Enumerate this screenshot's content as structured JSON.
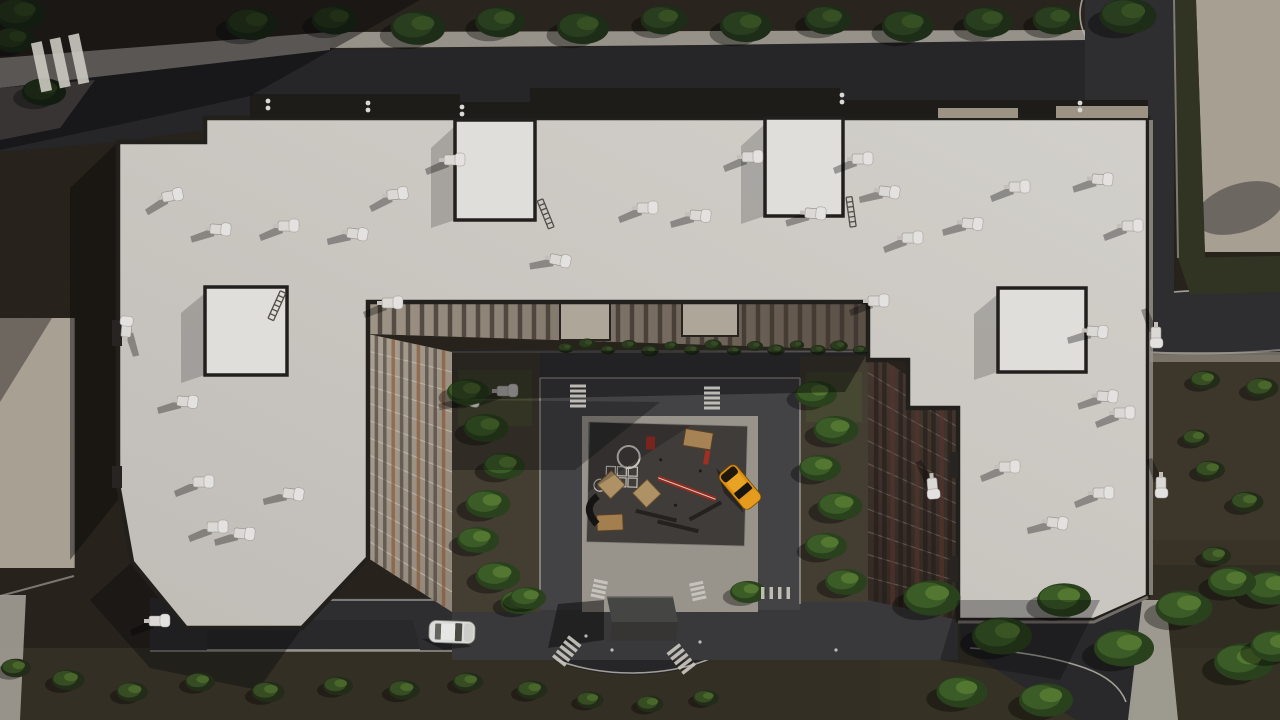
{
  "scene": {
    "title": "Aerial top-down 3D render of a residential apartment complex",
    "description": "U-shaped multi-wing apartment building with light flat roofs, rooftop HVAC units and stair penthouses, inner courtyard with playground and loop road, oval traffic circle with underground-parking entrance box, perimeter streets, dirt ground and rows of trees",
    "lighting": "low sun from the right; long shadows cast to the lower-left"
  },
  "palette": {
    "dirt": "#332e25",
    "dirt_light": "#453e31",
    "dirt_bottom": "#3a3428",
    "dirt_top": "#2c2820",
    "asphalt": "#313033",
    "asphalt_dark": "#29282a",
    "asphalt_apron": "#2c2b2d",
    "asphalt_lit": "#6e6a62",
    "courtyard_ground": "#3d3c3e",
    "loop_road": "#47474a",
    "sidewalk": "#b4afa6",
    "paving_light": "#a8a39a",
    "apron_paving": "#a29d94",
    "roof": "#d9d6d1",
    "roof_bright": "#edebe7",
    "parapet": "#25221e",
    "roof_band": "#201e1b",
    "facade_beige": "#b0a597",
    "facade_dark": "#46392f",
    "facade_accent": "#8c4f26",
    "tree_dark": "#2c4220",
    "tree_bright": "#40622a",
    "hedge": "#343726",
    "lawn": "#4f5a33",
    "playground_surface": "#44403e",
    "wood": "#b08a5a",
    "equipment_red": "#a83224",
    "taxi_orange": "#ef9a12",
    "car_white": "#e8e8e6",
    "hvac_white": "#e8e6e2",
    "marking_white": "#d8d5cd",
    "shadow": "rgba(10,10,12,0.5)"
  },
  "building": {
    "wings": [
      "left wing",
      "top bar",
      "right wing"
    ],
    "penthouses": 4,
    "hvac_count": 38,
    "inner_facades": "beige with dark window strips (left/top), dark brown with maroon strips (right)"
  },
  "objects": {
    "vehicles": [
      {
        "name": "orange-taxi",
        "x": 740,
        "y": 487,
        "rotation": 50,
        "color_ref": "taxi_orange"
      },
      {
        "name": "white-sedan",
        "x": 452,
        "y": 632,
        "rotation": 2,
        "color_ref": "car_white"
      }
    ],
    "oval_structure": {
      "name": "parking-entrance-box",
      "x": 640,
      "y": 618
    },
    "playground": {
      "surface": "dark rubber pad",
      "equipment": [
        "game-circle-marking",
        "hopscotch-grid",
        "wooden-table",
        "sand-diamond-1",
        "sand-diamond-2",
        "balance-beam",
        "benches",
        "wood-box",
        "climb-tube",
        "red-panel"
      ]
    },
    "hvac_units": [
      [
        165,
        196,
        -10
      ],
      [
        213,
        228,
        4
      ],
      [
        281,
        225,
        0
      ],
      [
        350,
        232,
        8
      ],
      [
        390,
        194,
        -6
      ],
      [
        447,
        159,
        0
      ],
      [
        553,
        258,
        12
      ],
      [
        640,
        207,
        0
      ],
      [
        693,
        214,
        6
      ],
      [
        745,
        156,
        0
      ],
      [
        808,
        212,
        4
      ],
      [
        855,
        158,
        0
      ],
      [
        882,
        190,
        8
      ],
      [
        905,
        237,
        0
      ],
      [
        965,
        222,
        6
      ],
      [
        1012,
        186,
        0
      ],
      [
        1095,
        178,
        4
      ],
      [
        1125,
        225,
        0
      ],
      [
        385,
        302,
        0
      ],
      [
        462,
        398,
        10
      ],
      [
        500,
        390,
        0
      ],
      [
        180,
        400,
        6
      ],
      [
        196,
        481,
        0
      ],
      [
        286,
        492,
        8
      ],
      [
        210,
        526,
        0
      ],
      [
        237,
        532,
        6
      ],
      [
        1002,
        466,
        0
      ],
      [
        1050,
        521,
        8
      ],
      [
        1096,
        492,
        0
      ],
      [
        1100,
        395,
        4
      ],
      [
        1117,
        412,
        0
      ],
      [
        1090,
        330,
        6
      ],
      [
        933,
        481,
        85
      ],
      [
        1157,
        330,
        90
      ],
      [
        1162,
        480,
        90
      ],
      [
        125,
        334,
        -85
      ],
      [
        152,
        620,
        0
      ],
      [
        871,
        300,
        0
      ]
    ],
    "ladders": [
      [
        540,
        200,
        -22
      ],
      [
        849,
        197,
        -8
      ],
      [
        283,
        292,
        24
      ]
    ],
    "roof_vents": [
      [
        368,
        103
      ],
      [
        462,
        107
      ],
      [
        842,
        95
      ],
      [
        1080,
        103
      ],
      [
        268,
        101
      ]
    ],
    "pedestrians": [
      [
        612,
        650
      ],
      [
        700,
        642
      ],
      [
        586,
        636
      ],
      [
        836,
        650
      ]
    ]
  },
  "vegetation": {
    "groups": [
      {
        "name": "top-tree-row",
        "style": "dark",
        "items": [
          [
            20,
            14,
            1
          ],
          [
            252,
            24,
            1
          ],
          [
            335,
            20,
            0.9
          ],
          [
            418,
            28,
            1.05
          ],
          [
            500,
            22,
            0.95
          ],
          [
            583,
            28,
            1
          ],
          [
            664,
            20,
            0.9
          ],
          [
            746,
            26,
            1
          ],
          [
            828,
            20,
            0.9
          ],
          [
            908,
            26,
            1
          ],
          [
            988,
            22,
            0.95
          ],
          [
            1056,
            20,
            0.9
          ],
          [
            1128,
            16,
            1.1
          ],
          [
            14,
            40,
            0.8
          ],
          [
            44,
            92,
            0.85
          ]
        ]
      },
      {
        "name": "courtyard-trees-left",
        "style": "bright",
        "items": [
          [
            468,
            392,
            0.7
          ],
          [
            486,
            428,
            0.75
          ],
          [
            504,
            466,
            0.7
          ],
          [
            488,
            504,
            0.75
          ],
          [
            478,
            540,
            0.7
          ],
          [
            498,
            576,
            0.75
          ],
          [
            520,
            602,
            0.65
          ]
        ]
      },
      {
        "name": "courtyard-trees-right",
        "style": "bright",
        "items": [
          [
            816,
            394,
            0.7
          ],
          [
            836,
            430,
            0.75
          ],
          [
            820,
            468,
            0.7
          ],
          [
            840,
            506,
            0.75
          ],
          [
            826,
            546,
            0.7
          ],
          [
            846,
            582,
            0.7
          ]
        ]
      },
      {
        "name": "trees-bottom-right",
        "style": "bright",
        "items": [
          [
            932,
            598,
            0.95
          ],
          [
            1002,
            636,
            1
          ],
          [
            1064,
            600,
            0.9
          ],
          [
            1124,
            648,
            1
          ],
          [
            1184,
            608,
            0.95
          ],
          [
            1244,
            662,
            1
          ],
          [
            1272,
            588,
            0.9
          ],
          [
            962,
            692,
            0.85
          ],
          [
            1046,
            700,
            0.9
          ],
          [
            1232,
            582,
            0.8
          ],
          [
            1276,
            646,
            0.85
          ]
        ]
      },
      {
        "name": "trees-near-oval",
        "style": "bright",
        "items": [
          [
            528,
            598,
            0.6
          ],
          [
            748,
            592,
            0.6
          ]
        ]
      },
      {
        "name": "bushes-right",
        "style": "bush",
        "items": [
          [
            1205,
            380,
            1
          ],
          [
            1262,
            388,
            1.1
          ],
          [
            1210,
            470,
            1
          ],
          [
            1247,
            502,
            1.1
          ],
          [
            1216,
            556,
            1
          ],
          [
            1196,
            438,
            0.9
          ]
        ]
      },
      {
        "name": "bushes-bottom-left",
        "style": "bush",
        "items": [
          [
            16,
            668,
            1
          ],
          [
            68,
            680,
            1.1
          ],
          [
            132,
            692,
            1.05
          ],
          [
            200,
            682,
            1
          ],
          [
            268,
            692,
            1.1
          ],
          [
            338,
            686,
            1
          ],
          [
            404,
            690,
            1.05
          ],
          [
            468,
            682,
            1
          ],
          [
            532,
            690,
            1
          ],
          [
            590,
            700,
            0.9
          ],
          [
            650,
            704,
            0.9
          ],
          [
            706,
            698,
            0.85
          ]
        ]
      },
      {
        "name": "facade-shrub-row",
        "style": "shrub",
        "items": [
          [
            566,
            348,
            1
          ],
          [
            587,
            344,
            1.1
          ],
          [
            608,
            350,
            0.9
          ],
          [
            629,
            345,
            1
          ],
          [
            650,
            351,
            1.1
          ],
          [
            671,
            346,
            0.9
          ],
          [
            692,
            350,
            1
          ],
          [
            713,
            345,
            1.1
          ],
          [
            734,
            351,
            0.9
          ],
          [
            755,
            346,
            1
          ],
          [
            776,
            350,
            1.1
          ],
          [
            797,
            345,
            0.9
          ],
          [
            818,
            350,
            1
          ],
          [
            839,
            346,
            1.1
          ],
          [
            860,
            350,
            0.9
          ]
        ]
      }
    ]
  },
  "road_markings": {
    "crosswalks": [
      {
        "x": 64,
        "y": 62,
        "rot": -12,
        "bars": 3,
        "bw": 11,
        "bh": 50,
        "gap": 8,
        "dir": "row"
      },
      {
        "x": 578,
        "y": 397,
        "rot": 0,
        "bars": 5,
        "bw": 16,
        "bh": 3,
        "gap": 2,
        "dir": "col"
      },
      {
        "x": 712,
        "y": 399,
        "rot": 0,
        "bars": 5,
        "bw": 16,
        "bh": 3,
        "gap": 2,
        "dir": "col"
      },
      {
        "x": 599,
        "y": 590,
        "rot": 12,
        "bars": 4,
        "bw": 14,
        "bh": 3,
        "gap": 2,
        "dir": "col"
      },
      {
        "x": 698,
        "y": 592,
        "rot": -12,
        "bars": 4,
        "bw": 14,
        "bh": 3,
        "gap": 2,
        "dir": "col"
      },
      {
        "x": 566,
        "y": 652,
        "rot": 38,
        "bars": 5,
        "bw": 16,
        "bh": 3.5,
        "gap": 2.5,
        "dir": "col"
      },
      {
        "x": 682,
        "y": 660,
        "rot": -38,
        "bars": 5,
        "bw": 16,
        "bh": 3.5,
        "gap": 2.5,
        "dir": "col"
      },
      {
        "x": 778,
        "y": 593,
        "rot": 0,
        "bars": 4,
        "bw": 3.5,
        "bh": 12,
        "gap": 5,
        "dir": "row"
      }
    ]
  }
}
